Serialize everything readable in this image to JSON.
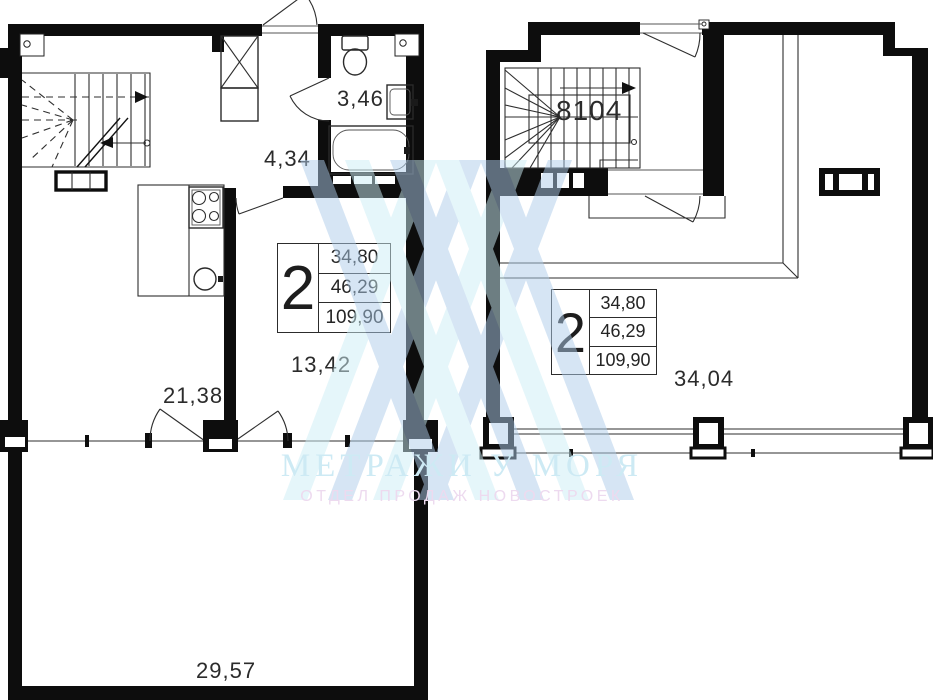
{
  "page": {
    "background": "#ffffff"
  },
  "info_box": {
    "rooms_count": "2",
    "rows": [
      "34,80",
      "46,29",
      "109,90"
    ]
  },
  "left_plan": {
    "area_labels": {
      "living_kitchen": "21,38",
      "bedroom": "13,42",
      "hallway": "4,34",
      "bathroom": "3,46",
      "terrace": "29,57"
    }
  },
  "right_plan": {
    "area_labels": {
      "stair_hall": "8104",
      "living_room": "34,04"
    }
  },
  "watermark": {
    "brand": "МЕТРАЖИ У МОРЯ",
    "tagline": "ОТДЕЛ ПРОДАЖ НОВОСТРОЕК",
    "logo_colors": {
      "blue": "#aecdeb",
      "cyan": "#cdeef6"
    },
    "brand_color": "#cdeaf4",
    "tagline_color": "#eddaef"
  }
}
